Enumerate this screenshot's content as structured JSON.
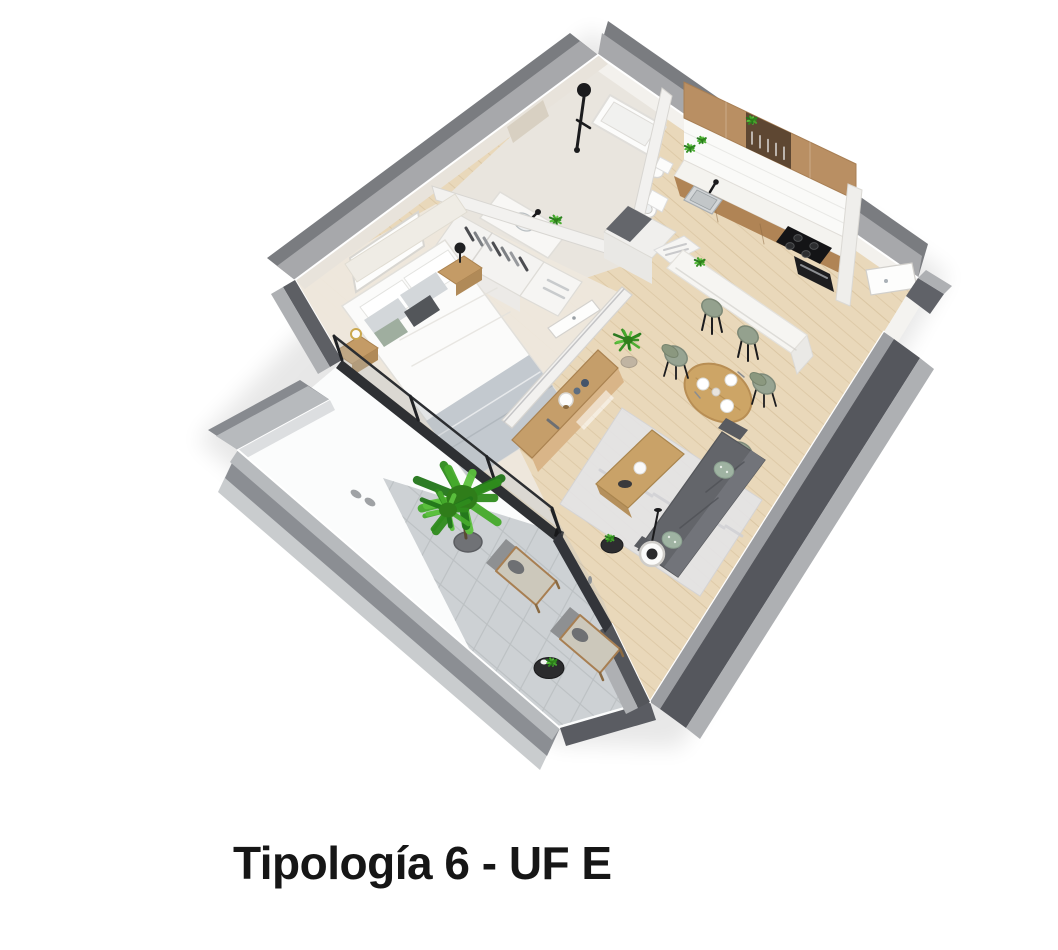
{
  "caption": {
    "title": "Tipología 6 - UF E"
  },
  "palette": {
    "background": "#ffffff",
    "text": "#161616",
    "floor_wood": "#e9d8ba",
    "plank_line": "#d6c09b",
    "carpet": "#eee8dd",
    "bath_tile": "#e9e5de",
    "terrace_tile": "#cdd1d4",
    "terrace_grout": "#bcc0c3",
    "wall_dark": "#55575d",
    "wall_cap_light": "#9c9ea2",
    "wall_outer_light": "#aeb0b3",
    "wall_far_cap": "#a7a8ab",
    "wall_far_dark": "#7a7c80",
    "interior_wall": "#f2f1ef",
    "wall_beige": "#e8e3db",
    "parapet_cap": "#b7babd",
    "parapet_dark": "#8b8e93",
    "cabinet_wood": "#b98f63",
    "cabinet_base": "#b08455",
    "shelf_dark": "#5e4732",
    "counter_white": "#f4f3ef",
    "fixture_white": "#fcfcfb",
    "appliance_black": "#141416",
    "console_wood": "#c59e6a",
    "table_wood": "#cda566",
    "nightstand_wood": "#c49b66",
    "sofa_gray": "#63656a",
    "sage_green": "#97a492",
    "pillow_sage": "#9fb3a2",
    "rug_gray": "#e4e4e6",
    "blanket_gray": "#c3c9cf",
    "plant_green": "#46a82d",
    "frame_black": "#2e3033",
    "glass_tint": "#b7bcbf"
  }
}
